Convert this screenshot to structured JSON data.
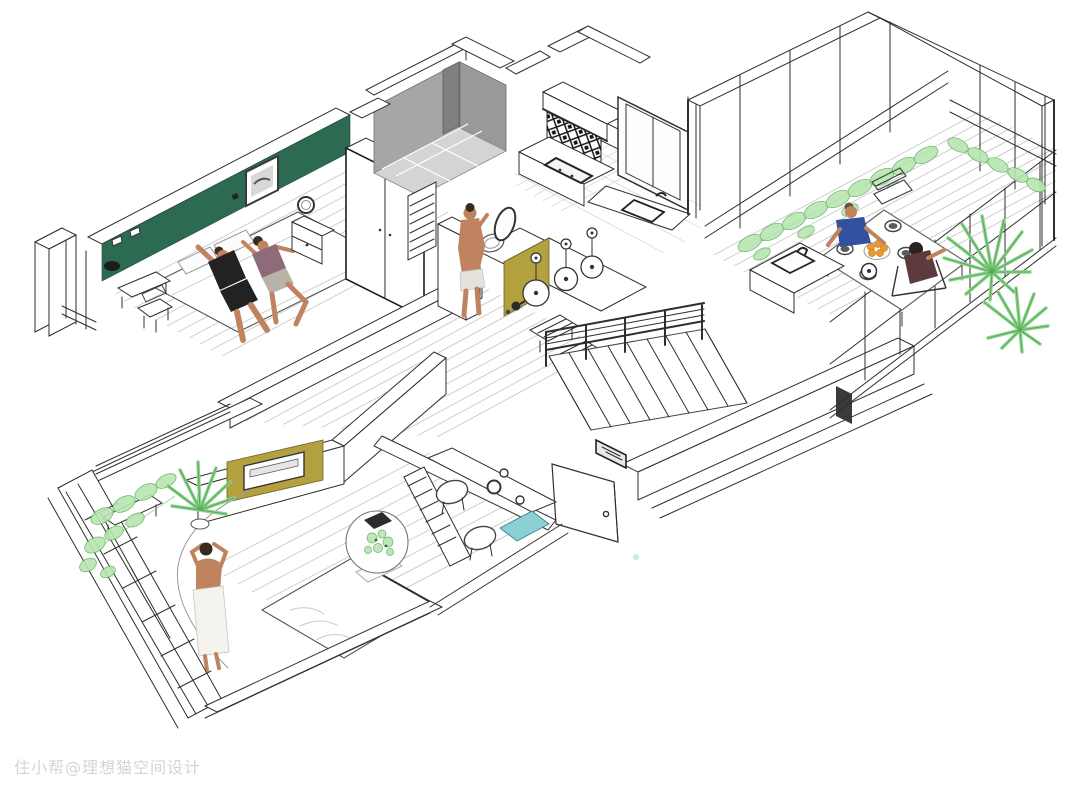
{
  "scene": {
    "type": "isometric 3D floor plan rendering of an apartment",
    "watermark": "住小帮@理想猫空间设计",
    "rooms": [
      {
        "id": "master-bedroom",
        "desc": "double bed with couple lying down, dark green accent wall, framed picture, wardrobe, nightstand with round mirror, window bay with chair"
      },
      {
        "id": "walk-in-shower",
        "desc": "grey tiled shower room"
      },
      {
        "id": "bathroom",
        "desc": "man standing at round wash basin with oval mirror, mustard vanity end panel"
      },
      {
        "id": "island-bar",
        "desc": "counter with three white globe pendant lamps, two upholstered stools, tea set"
      },
      {
        "id": "kitchen",
        "desc": "black and white patterned backsplash, cooker hood, hob, tall window, sink counter"
      },
      {
        "id": "staircase",
        "desc": "descending stair flight with guard railing"
      },
      {
        "id": "entry",
        "desc": "open entrance door with round knob"
      },
      {
        "id": "living-corridor",
        "desc": "wood plank flooring"
      },
      {
        "id": "second-bedroom",
        "desc": "woman wrapped in white towel, bed, desk with two round stools, round plant table, mustard TV niche, teal bench"
      },
      {
        "id": "plant-balcony",
        "desc": "glazed balcony with hanging greenery, potted palm and bench"
      },
      {
        "id": "dining-balcony",
        "desc": "glazed balcony, dining table with man and woman, plates, bowl of oranges, kettle, small sink counter, climbing plants, large palms"
      }
    ]
  },
  "colors": {
    "accent-green-wall": "#2d6a52",
    "accent-olive": "#b3a140",
    "accent-teal": "#8bd0d4",
    "plant-light": "#b9e6b2",
    "plant-mid": "#8fd48f",
    "plant-dark": "#57ab57",
    "shower-gray": "#a6a6a6",
    "shower-gray-dark": "#808080",
    "shower-floor": "#d4d4d4",
    "skin": "#c08360",
    "hair-dark": "#3a2b20",
    "shirt-black": "#222222",
    "top-mauve": "#8e6b7a",
    "shirt-blue": "#32519e",
    "dress-maroon": "#5d3a3c",
    "towel": "#f5f3ee",
    "orange": "#e89a30",
    "line": "#2e2e2e",
    "floor-line": "#c9c9c9",
    "watermark-gray": "#9a9a9a"
  }
}
